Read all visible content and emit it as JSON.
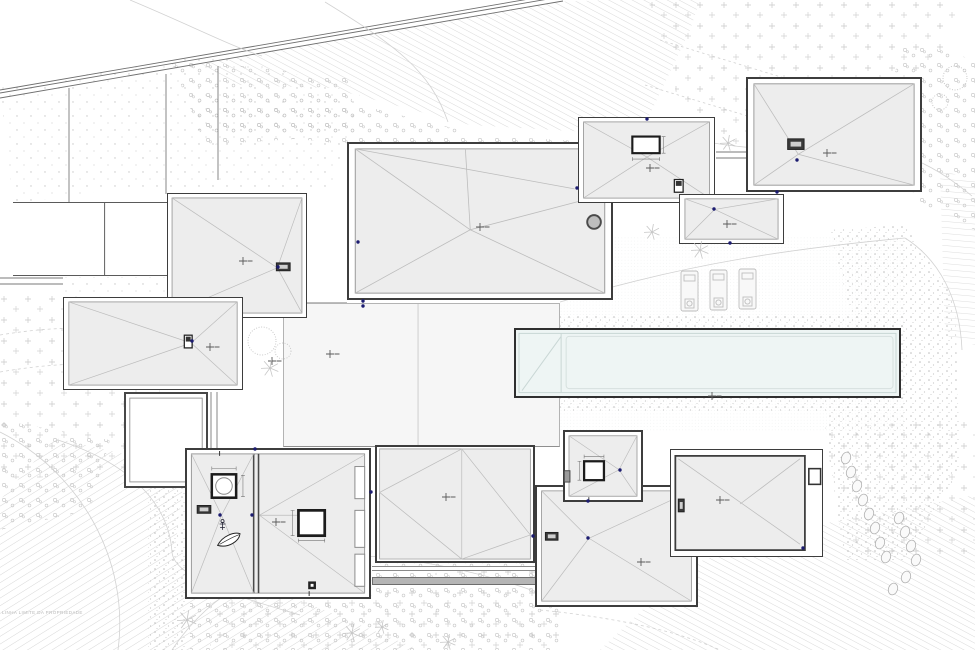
{
  "document": {
    "watermark": "LINHA LIMITE DA PROPRIEDADE"
  },
  "colors": {
    "paper": "#ffffff",
    "outline": "#3d3d3d",
    "roof_fill": "#ededed",
    "roof_edge": "#8f8f8f",
    "roof_line": "#bcbcbc",
    "drain_dot": "#1c1c70",
    "marker": "#5a5a5a",
    "vegetation": "#c6c6c6",
    "pool_water": "#eef5f4",
    "pool_line": "#c9d7d5",
    "path_fill": "#b5b5b5",
    "hatch": "#d0d0d0"
  },
  "plan": {
    "drain_dots": [
      [
        647,
        119
      ],
      [
        797,
        160
      ],
      [
        714,
        209
      ],
      [
        358,
        242
      ],
      [
        577,
        188
      ],
      [
        363,
        301
      ],
      [
        363,
        306
      ],
      [
        192,
        341
      ],
      [
        278,
        267
      ],
      [
        220,
        515
      ],
      [
        252,
        515
      ],
      [
        255,
        449
      ],
      [
        371,
        492
      ],
      [
        533,
        536
      ],
      [
        588,
        538
      ],
      [
        620,
        470
      ],
      [
        803,
        548
      ],
      [
        730,
        243
      ],
      [
        777,
        192
      ],
      [
        588,
        501
      ]
    ],
    "spot_markers": [
      [
        243,
        261
      ],
      [
        210,
        347
      ],
      [
        480,
        227
      ],
      [
        650,
        168
      ],
      [
        727,
        224
      ],
      [
        827,
        153
      ],
      [
        446,
        497
      ],
      [
        330,
        354
      ],
      [
        272,
        361
      ],
      [
        720,
        500
      ],
      [
        641,
        562
      ],
      [
        712,
        396
      ],
      [
        276,
        522
      ]
    ],
    "star_plants": [
      [
        270,
        368,
        9
      ],
      [
        652,
        232,
        8
      ],
      [
        700,
        250,
        9
      ],
      [
        728,
        143,
        8
      ],
      [
        187,
        620,
        10
      ],
      [
        352,
        633,
        9
      ],
      [
        382,
        627,
        7
      ],
      [
        448,
        642,
        8
      ]
    ],
    "bushes": [
      [
        262,
        341,
        14
      ],
      [
        283,
        351,
        8
      ],
      [
        955,
        78,
        12
      ],
      [
        940,
        102,
        8
      ]
    ],
    "stones": [
      [
        846,
        458
      ],
      [
        851,
        472
      ],
      [
        857,
        486
      ],
      [
        863,
        500
      ],
      [
        869,
        514
      ],
      [
        875,
        528
      ],
      [
        899,
        518
      ],
      [
        905,
        532
      ],
      [
        911,
        546
      ],
      [
        916,
        560
      ],
      [
        906,
        577
      ],
      [
        893,
        589
      ],
      [
        880,
        543
      ],
      [
        886,
        557
      ]
    ],
    "loungers": [
      [
        681,
        271
      ],
      [
        710,
        270
      ],
      [
        739,
        269
      ]
    ]
  }
}
